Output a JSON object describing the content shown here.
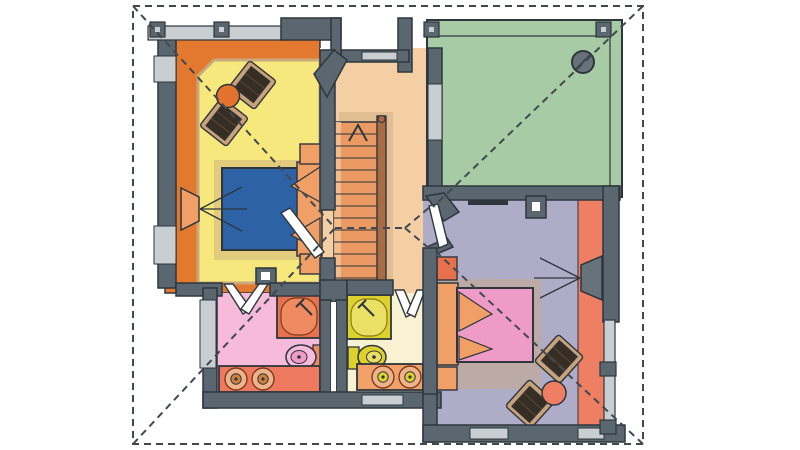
{
  "canvas": {
    "width": 800,
    "height": 450,
    "background": "#ffffff"
  },
  "drawing": {
    "kind": "floor-plan",
    "visible_text": [],
    "roof_outline": "dashed rectangle with hip diagonals and central ridge"
  },
  "colors": {
    "bg": "#ffffff",
    "outline": "#2e363c",
    "roofLine": "#41484f",
    "wall": "#5b6770",
    "wallLight": "#c9ced3",
    "orange": "#e2792f",
    "orangeLight": "#f09f66",
    "yellow": "#f6e87d",
    "tan": "#c9a87c",
    "peach": "#f4cfa4",
    "stairTread": "#ec9a63",
    "stairTreadLight": "#f6c193",
    "stairRail": "#a86b46",
    "green": "#a7cba4",
    "purple": "#afacc8",
    "salmon": "#ee7f63",
    "pinkFloor": "#f6bada",
    "pinkBed": "#ef9bc8",
    "cream": "#f8f1d2",
    "blue": "#2d62a6",
    "chairDark": "#362d25",
    "chairTrim": "#c9a17a",
    "tvGray": "#68727a",
    "fixtureYellow": "#ddd12e",
    "fixtureYellowLight": "#e9e065",
    "showerOrange": "#e8714d",
    "showerOrangeLight": "#f08a60",
    "vanityLeft": "#ed7a5e",
    "vanityRight": "#f0a269",
    "sinkRing": "#efb289",
    "sinkBowl": "#d0813f",
    "tableOrange": "#e2722e",
    "doorWhite": "#ffffff"
  },
  "rooms": [
    {
      "id": "bedroom-left",
      "floor": "yellow",
      "border_zone": "orange"
    },
    {
      "id": "hallway-stairs",
      "floor": "peach"
    },
    {
      "id": "terrace-top-right",
      "floor": "green"
    },
    {
      "id": "bedroom-right",
      "floor": "purple",
      "side_zone": "salmon"
    },
    {
      "id": "bathroom-left",
      "floor": "pinkFloor"
    },
    {
      "id": "bathroom-right",
      "floor": "cream"
    }
  ],
  "furniture_icons": [
    "double-bed-blue",
    "double-bed-pink",
    "armchair-icon",
    "armchair-icon",
    "armchair-icon",
    "armchair-icon",
    "round-table-icon",
    "round-table-icon",
    "tv-icon",
    "tv-icon",
    "staircase-up-arrow",
    "corner-shower-icon",
    "corner-shower-icon",
    "toilet-icon",
    "toilet-icon",
    "double-sink-vanity",
    "double-sink-vanity",
    "chimney-circle-icon"
  ]
}
